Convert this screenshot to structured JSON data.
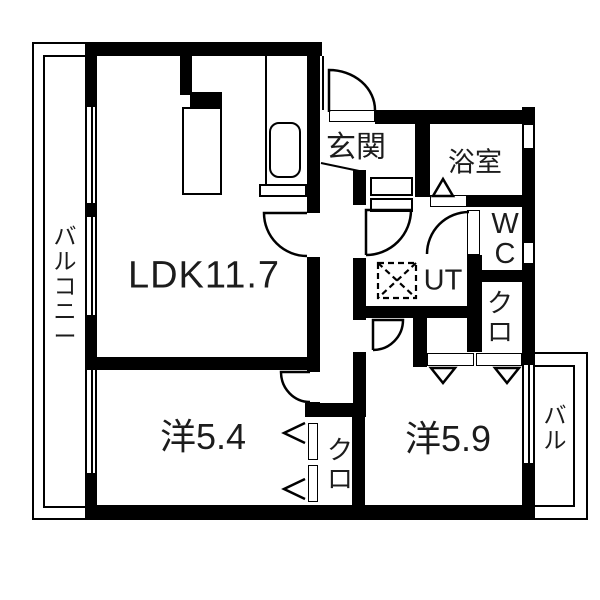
{
  "plan": {
    "labels": {
      "ldk": "LDK11.7",
      "western_room_1": "洋5.4",
      "western_room_2": "洋5.9",
      "entrance": "玄関",
      "bathroom": "浴室",
      "toilet": "WC",
      "utility": "UT",
      "closet_left": "クロ",
      "closet_right": "クロ",
      "balcony_main": "バルコニー",
      "balcony_sub": "バル"
    },
    "colors": {
      "wall": "#000000",
      "background": "#ffffff",
      "text": "#1c1c1c"
    }
  }
}
